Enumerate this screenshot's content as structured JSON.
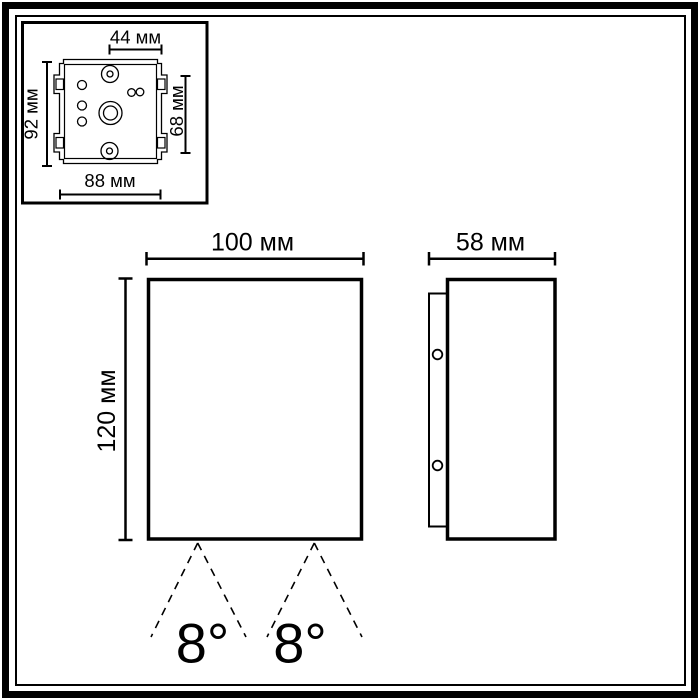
{
  "diagram": {
    "plate_view": {
      "width_top": "44 мм",
      "height_left": "92 мм",
      "height_right": "68 мм",
      "width_bottom": "88 мм"
    },
    "front_view": {
      "width": "100 мм",
      "height": "120 мм",
      "beam_angle_left": "8°",
      "beam_angle_right": "8°"
    },
    "side_view": {
      "depth": "58 мм"
    },
    "colors": {
      "line": "#000000",
      "background": "#ffffff"
    }
  }
}
